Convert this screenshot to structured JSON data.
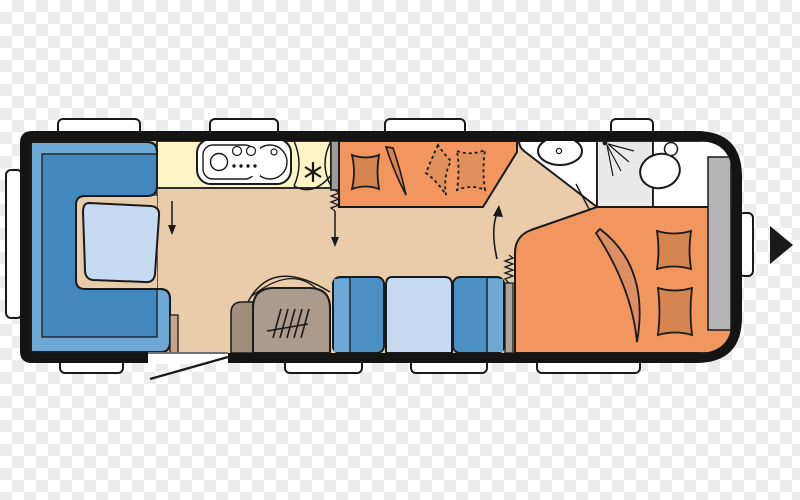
{
  "canvas": {
    "width": 800,
    "height": 500,
    "background": "transparency-checkerboard",
    "checker_size_px": 12
  },
  "colors": {
    "checker_gray": "#ececec",
    "checker_white": "#ffffff",
    "outline": "#1a1a1a",
    "body_black": "#141414",
    "floor_tan": "#e9cdab",
    "seat_blue": "#4b8fc3",
    "seat_blue_light": "#6ea9d6",
    "seat_blue_dark": "#4287bd",
    "table_blue": "#c6daf1",
    "kitchen_cream": "#fdf3c7",
    "bed_orange": "#f1965f",
    "cushion_orange": "#d5854f",
    "cushion_orange_dim": "#e2905b",
    "blanket_orange": "#dc8f62",
    "heater_brown": "#ac9a8c",
    "heater_brown_dark": "#a08e7d",
    "wardrobe_gray": "#b5b5b5",
    "shower_gray": "#e9e9e9",
    "divider_gray": "#9c9c9c",
    "strip_tan": "#c9a387",
    "strip_gray": "#b2a294",
    "white": "#ffffff"
  },
  "floorplan": {
    "kind": "caravan floor plan",
    "travel_direction": "right",
    "window_tabs": {
      "top": 4,
      "bottom": 4,
      "front_left": 1,
      "rear_right": 1
    },
    "areas": [
      {
        "id": "front-lounge",
        "label": "U-shaped lounge seating with table"
      },
      {
        "id": "kitchen",
        "label": "kitchen block with cooktop, sink and fridge (snowflake)"
      },
      {
        "id": "bunk-beds",
        "label": "bunk beds, upper bunk shown dashed"
      },
      {
        "id": "middle-dinette",
        "label": "two bench seats with table"
      },
      {
        "id": "heater",
        "label": "heater with grille"
      },
      {
        "id": "washroom",
        "label": "washbasin, shower and toilet"
      },
      {
        "id": "wardrobe",
        "label": "wardrobe"
      },
      {
        "id": "rear-bed",
        "label": "double bed with two pillows and folded blanket"
      },
      {
        "id": "entrance-door",
        "label": "entrance door shown open"
      }
    ]
  }
}
